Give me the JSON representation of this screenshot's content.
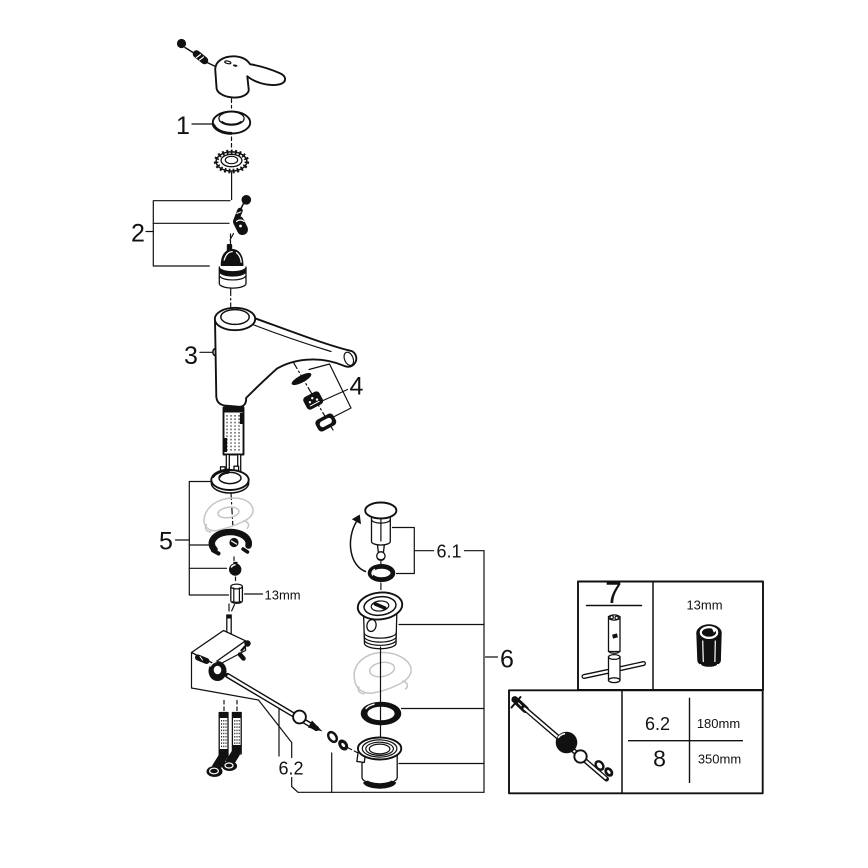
{
  "callouts": {
    "part1": "1",
    "part2": "2",
    "part3": "3",
    "part4": "4",
    "part5": "5",
    "part6": "6",
    "part6_1": "6.1",
    "part6_2": "6.2"
  },
  "annotations": {
    "mounting_nut_size": "13mm"
  },
  "tool_table": {
    "tool_number": "7",
    "socket_size": "13mm"
  },
  "rod_table": {
    "rows": [
      {
        "part": "6.2",
        "length": "180mm"
      },
      {
        "part": "8",
        "length": "350mm"
      }
    ]
  },
  "colors": {
    "line": "#111111",
    "ghost": "#c5c5c5",
    "background": "#ffffff"
  }
}
